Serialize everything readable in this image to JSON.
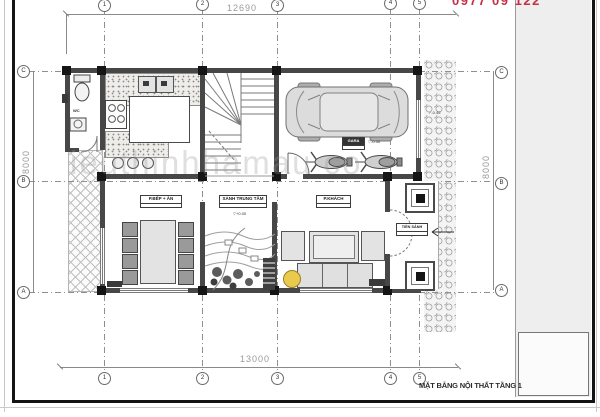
{
  "sheet": {
    "watermark": "ieuthinhhamau co",
    "hotline_partial": "0977 09 122",
    "title": "MẶT BẰNG NỘI THẤT TẦNG 1"
  },
  "dimensions": {
    "top": "12690",
    "bottom": "13000",
    "left": "8000",
    "right": "8000"
  },
  "grid": {
    "cols": [
      "1",
      "2",
      "3",
      "4",
      "5"
    ],
    "rows": [
      "C",
      "B",
      "A"
    ]
  },
  "rooms": {
    "wc": {
      "label": "WC"
    },
    "kitchen_dining": {
      "label": "P.BẾP + ĂN"
    },
    "hall": {
      "label": "SẢNH TRUNG TÂM",
      "level": "+0.00"
    },
    "living": {
      "label": "P.KHÁCH"
    },
    "porch": {
      "label": "TIỀN SẢNH"
    },
    "garage": {
      "label": "GARA",
      "level": "-0.30"
    },
    "side_path": {
      "level": "-0.45"
    }
  },
  "colors": {
    "wall": "#474747",
    "accent_red": "#c53048",
    "plant_yellow": "#e9c94e"
  }
}
